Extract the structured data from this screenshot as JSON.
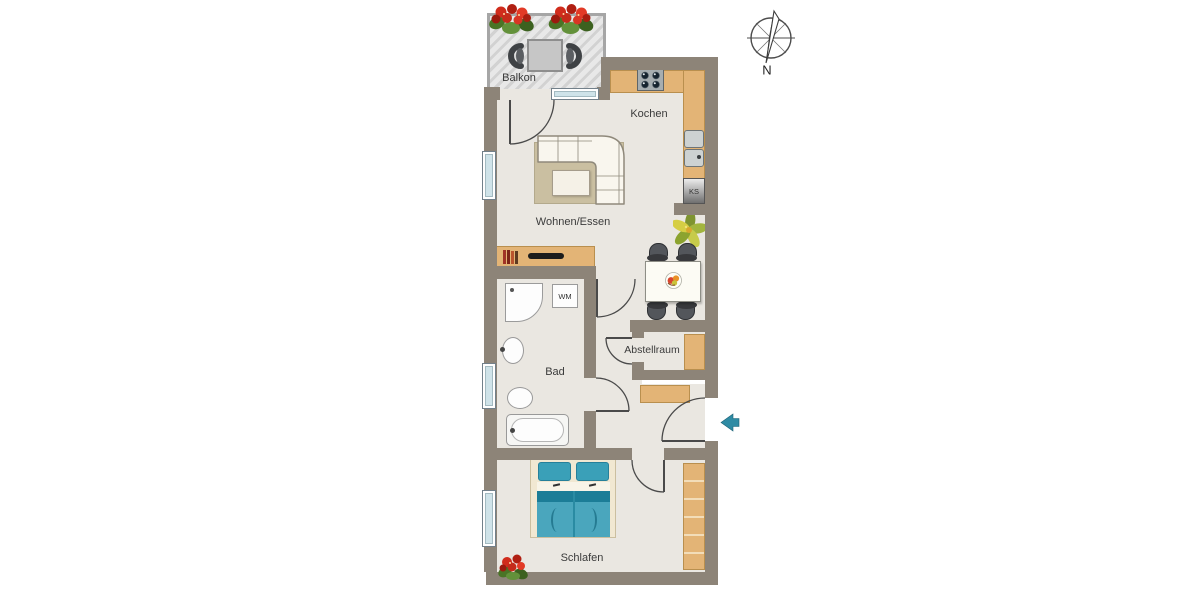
{
  "plan": {
    "rooms": {
      "balcony": "Balkon",
      "kitchen": "Kochen",
      "living_dining": "Wohnen/Essen",
      "bath": "Bad",
      "storage": "Abstellraum",
      "bedroom": "Schlafen"
    },
    "appliances": {
      "washing_machine": "WM",
      "fridge": "KS"
    },
    "compass": {
      "north": "N"
    }
  },
  "colors": {
    "wall": "#8d8478",
    "floor": "#eae7e1",
    "balcony-floor": "#e8e8e8",
    "balcony-stripe": "#d2d2d2",
    "tan": "#e3b476",
    "tan-border": "#b98f4e",
    "rug": "#cabfa1",
    "rug-border": "#b3a98c",
    "sofa": "#f9f6ee",
    "sofa-border": "#8f897b",
    "bed-teal": "#4aa6bd",
    "bed-teal-dark": "#1c7d97",
    "bed-frame": "#f1e8d2",
    "window-glass": "#cfe3e9",
    "door-line": "#4a4a4a",
    "entry-arrow": "#2f8ba4",
    "text": "#3b3b3b",
    "appliance-gray": "#cdd2d2"
  }
}
